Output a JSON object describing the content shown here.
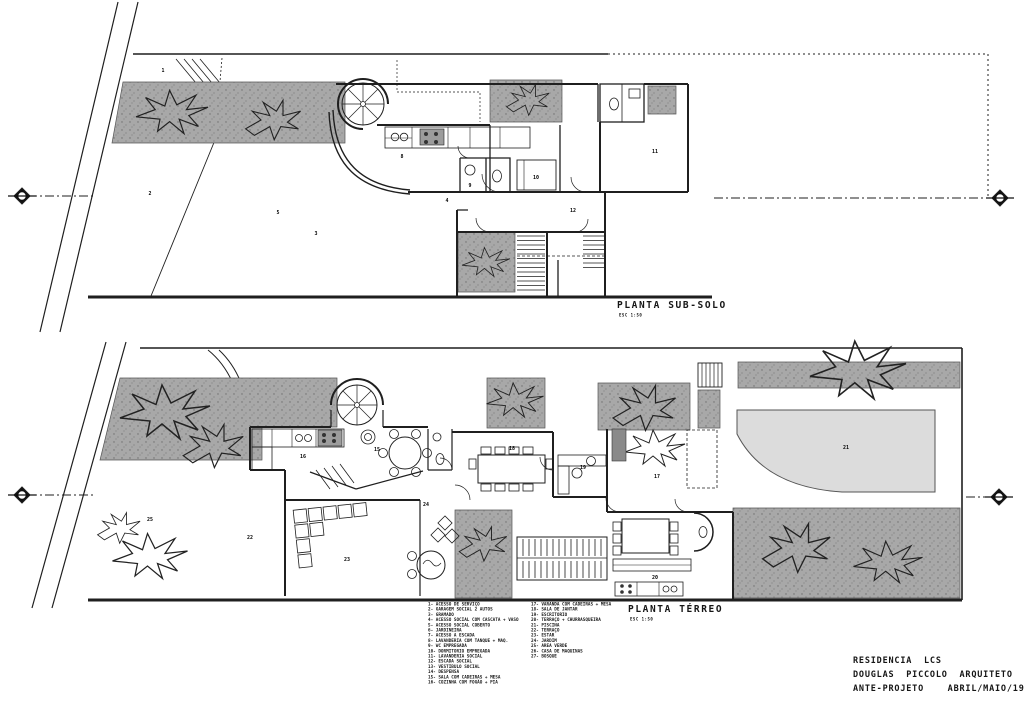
{
  "colors": {
    "ink": "#1f1f1f",
    "garden_gray": "#a8a8a8",
    "pool_gray": "#dcdcdc",
    "paper": "#ffffff"
  },
  "plan_titles": {
    "subsolo": {
      "label": "PLANTA SUB-SOLO",
      "scale": "ESC 1:50"
    },
    "terreo": {
      "label": "PLANTA TÉRREO",
      "scale": "ESC 1:50"
    }
  },
  "title_block": {
    "project": "RESIDENCIA  LCS",
    "architect": "DOUGLAS  PICCOLO  ARQUITETO",
    "phase": "ANTE-PROJETO    ABRIL/MAIO/1980"
  },
  "legend": {
    "left": [
      "1- ACESSO DE SERVIÇO",
      "2- GARAGEM SOCIAL 2 AUTOS",
      "3- GRAMADO",
      "4- ACESSO SOCIAL COM CASCATA + VASO",
      "5- ACESSO SOCIAL COBERTO",
      "6- JARDINEIRA",
      "7- ACESSO A ESCADA",
      "8- LAVANDERIA COM TANQUE + MAQ.",
      "9- WC EMPREGADA",
      "10- DORMITORIO EMPREGADA",
      "11- LAVANDERIA SOCIAL",
      "12- ESCADA SOCIAL",
      "13- VESTIBULO SOCIAL",
      "14- DESPENSA",
      "15- SALA COM CADEIRAS + MESA",
      "16- COZINHA COM FOGÃO + PIA"
    ],
    "right": [
      "17- VARANDA COM CADEIRAS + MESA",
      "18- SALA DE JANTAR",
      "19- ESCRITORIO",
      "20- TERRAÇO + CHURRASQUEIRA",
      "21- PISCINA",
      "22- TERRAÇO",
      "23- ESTAR",
      "24- JARDIM",
      "25- AREA VERDE",
      "26- CASA DE MAQUINAS",
      "27- BOSQUE"
    ]
  },
  "room_labels": {
    "subsolo": [
      {
        "t": "1",
        "x": 163,
        "y": 71
      },
      {
        "t": "2",
        "x": 150,
        "y": 194
      },
      {
        "t": "3",
        "x": 316,
        "y": 234
      },
      {
        "t": "4",
        "x": 447,
        "y": 201
      },
      {
        "t": "5",
        "x": 278,
        "y": 213
      },
      {
        "t": "8",
        "x": 402,
        "y": 157
      },
      {
        "t": "9",
        "x": 470,
        "y": 186
      },
      {
        "t": "10",
        "x": 536,
        "y": 178
      },
      {
        "t": "11",
        "x": 655,
        "y": 152
      },
      {
        "t": "12",
        "x": 573,
        "y": 211
      }
    ],
    "terreo": [
      {
        "t": "16",
        "x": 303,
        "y": 457
      },
      {
        "t": "15",
        "x": 377,
        "y": 450
      },
      {
        "t": "18",
        "x": 512,
        "y": 449
      },
      {
        "t": "19",
        "x": 583,
        "y": 468
      },
      {
        "t": "17",
        "x": 657,
        "y": 477
      },
      {
        "t": "22",
        "x": 250,
        "y": 538
      },
      {
        "t": "23",
        "x": 347,
        "y": 560
      },
      {
        "t": "24",
        "x": 426,
        "y": 505
      },
      {
        "t": "25",
        "x": 150,
        "y": 520
      },
      {
        "t": "20",
        "x": 655,
        "y": 578
      },
      {
        "t": "21",
        "x": 846,
        "y": 448
      }
    ]
  }
}
